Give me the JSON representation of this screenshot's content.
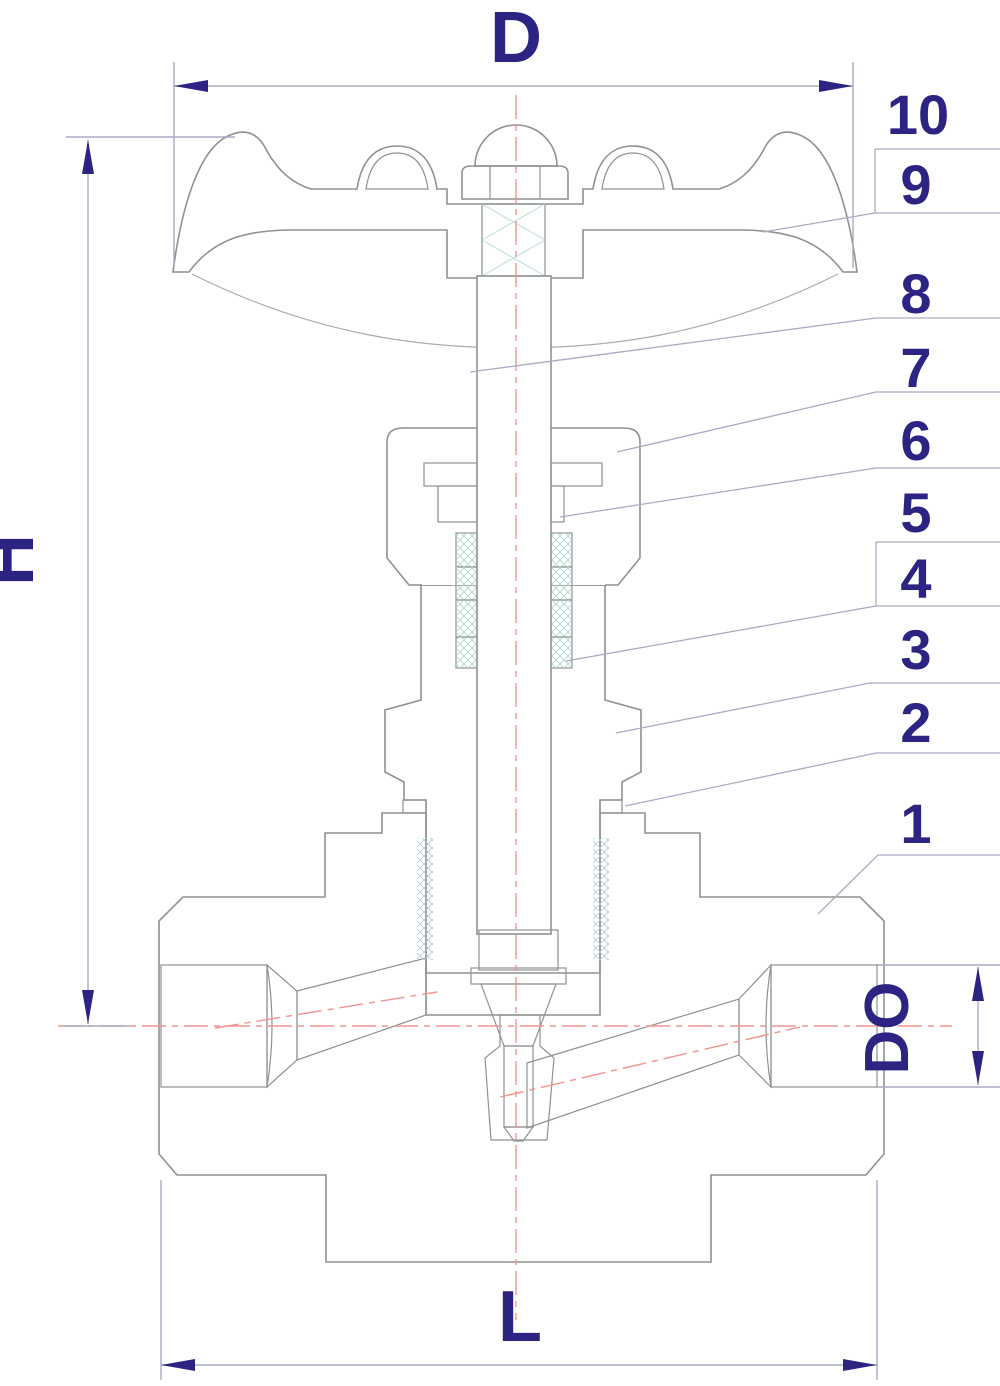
{
  "drawing": {
    "title": "needle valve cross-section diagram",
    "dimensions": {
      "diameter": "D",
      "height": "H",
      "length": "L",
      "bore": "DO"
    },
    "callouts": [
      "1",
      "2",
      "3",
      "4",
      "5",
      "6",
      "7",
      "8",
      "9",
      "10"
    ],
    "colors": {
      "label": "#2c2382",
      "outline": "#8e938f",
      "dimension_line": "#a9abc4",
      "centerline": "#f2938f",
      "hatch": "#d3ddd0",
      "hatch_alt": "#c9e4e0",
      "packing_fill": "#f2faf8",
      "gasket_fill": "#d4ece7"
    }
  }
}
